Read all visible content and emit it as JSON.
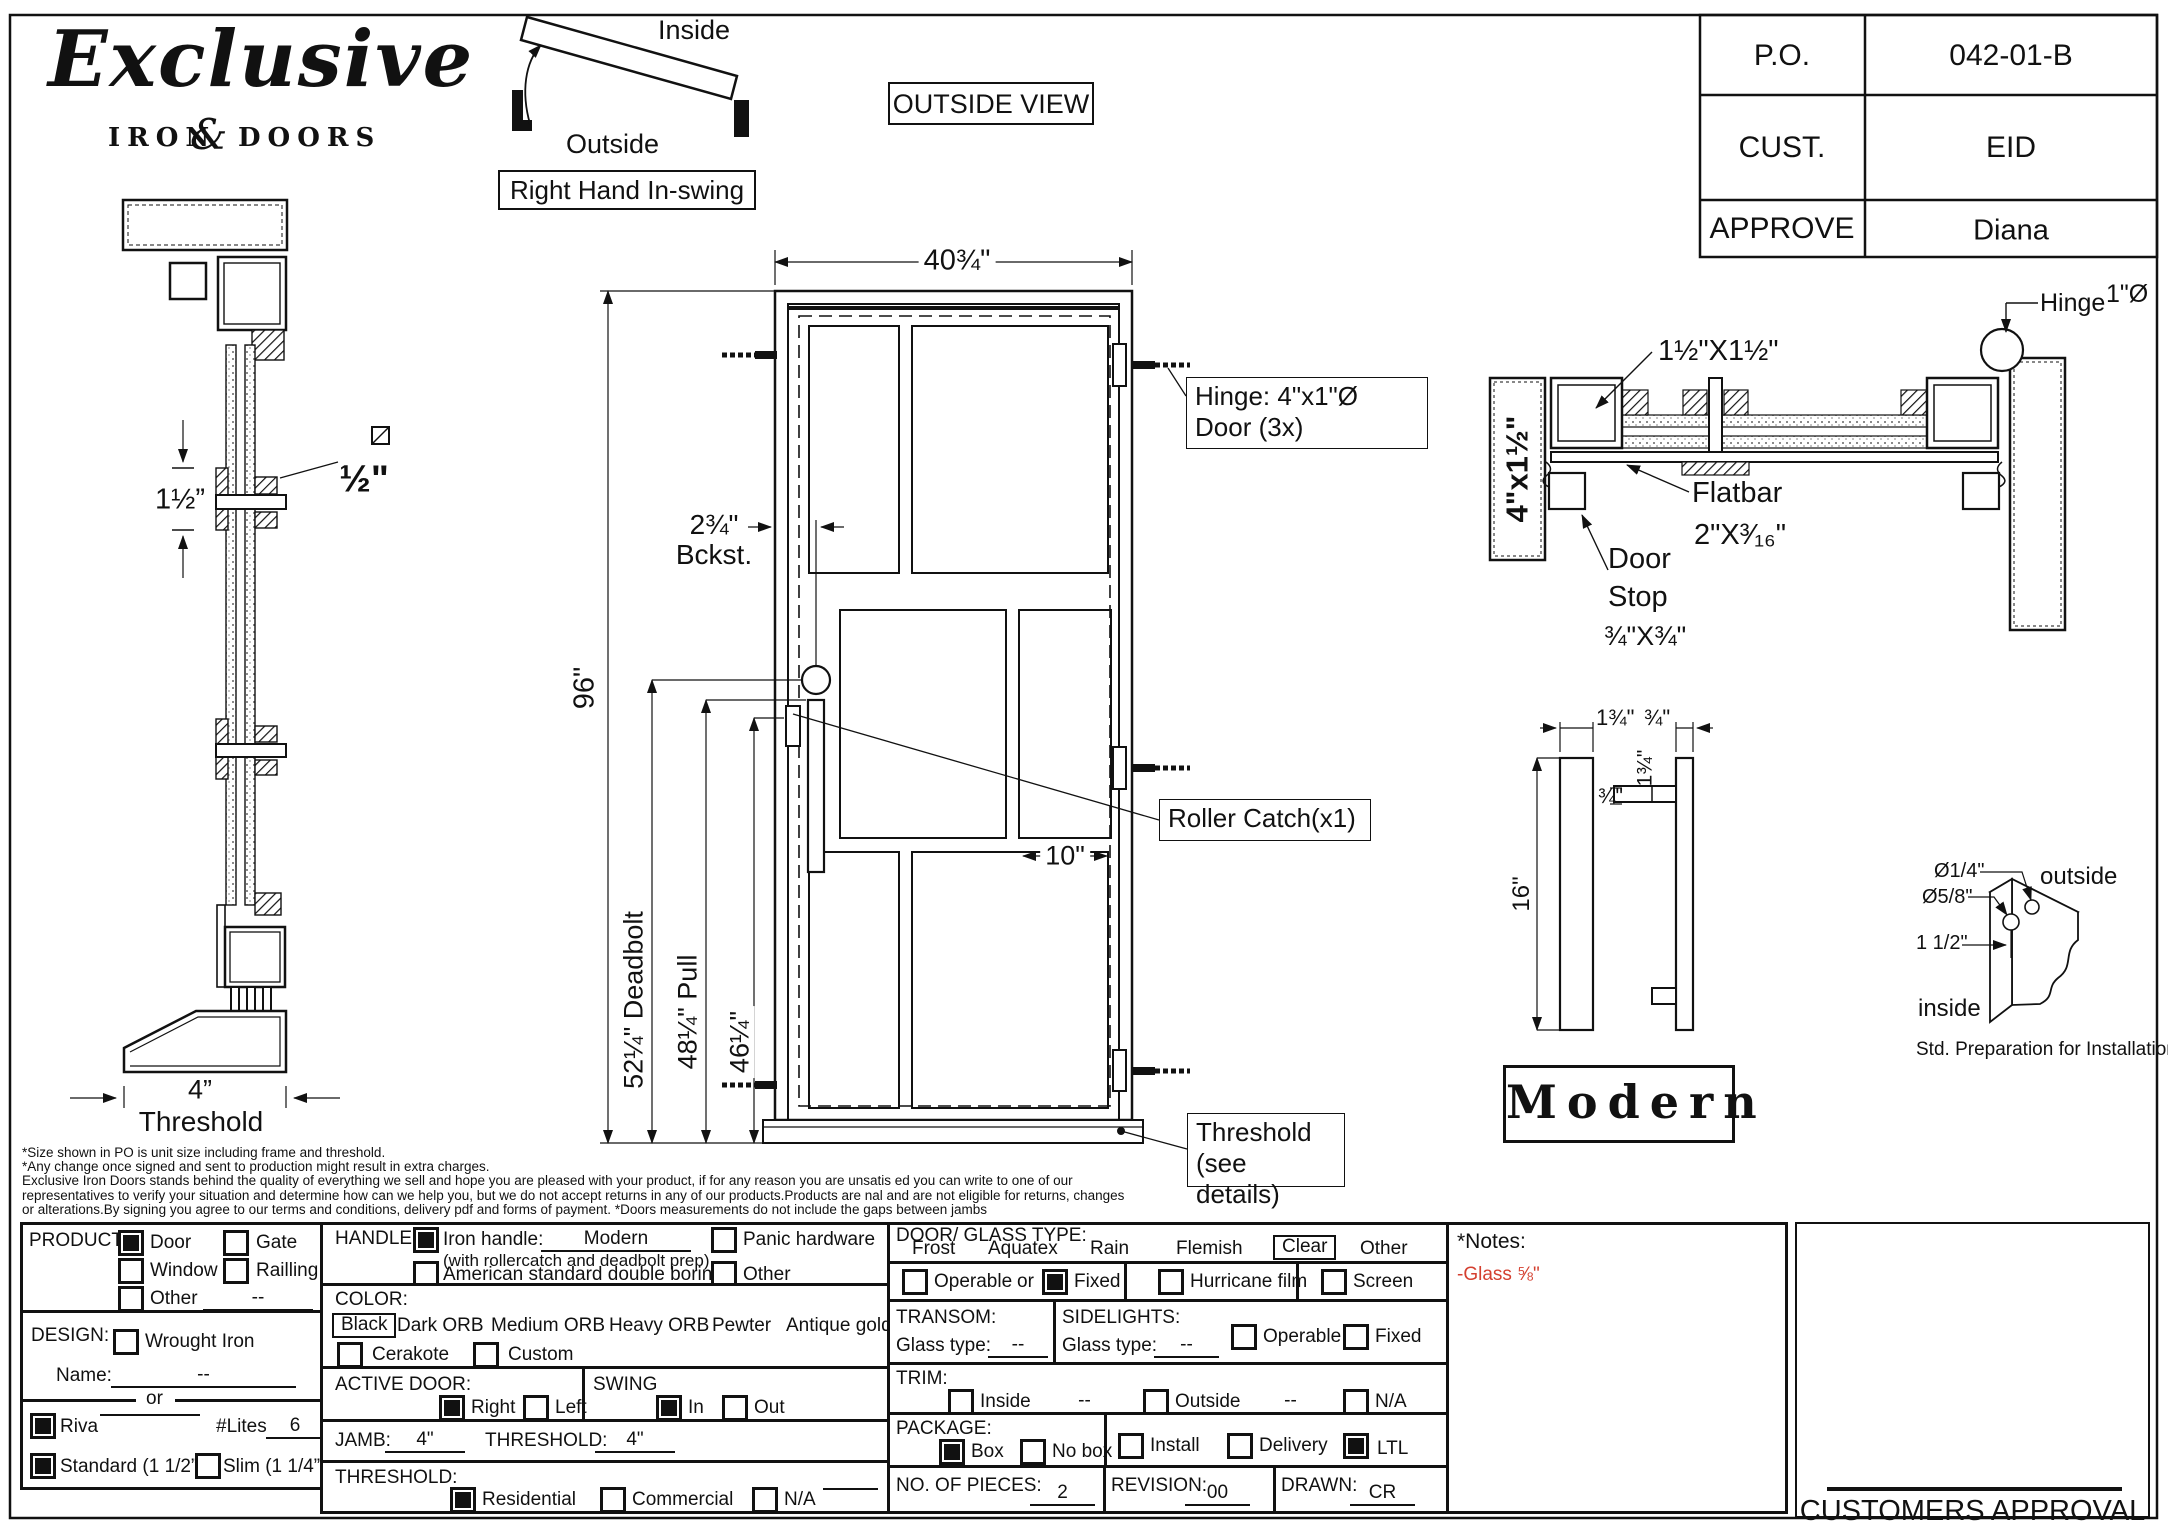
{
  "logo": {
    "script": "Exclusive",
    "sub_left": "IRON",
    "sub_amp": "&",
    "sub_right": "DOORS"
  },
  "swing": {
    "inside": "Inside",
    "outside": "Outside",
    "caption": "Right Hand In-swing"
  },
  "view_box": {
    "label": "OUTSIDE VIEW"
  },
  "po_table": {
    "rows": [
      {
        "label": "P.O.",
        "value": "042-01-B"
      },
      {
        "label": "CUST.",
        "value": "EID"
      },
      {
        "label": "APPROVE",
        "value": "Diana"
      }
    ]
  },
  "door_view": {
    "width_dim": "40¾\"",
    "height_dim": "96\"",
    "deadbolt_dim": "52¼\" Deadbolt",
    "pull_dim": "48¼\" Pull",
    "catch_dim": "46¼\"",
    "backset_line1": "2¾\"",
    "backset_line2": "Bckst.",
    "lite_dim": "10\"",
    "hinge_note_line1": "Hinge: 4\"x1\"Ø",
    "hinge_note_line2": "Door (3x)",
    "roller_note": "Roller Catch(x1)",
    "threshold_note_line1": "Threshold",
    "threshold_note_line2": "(see details)"
  },
  "profile_view": {
    "mullion_dim": "1½”",
    "bar_dim": "½\"",
    "threshold_dim": "4”",
    "threshold_label": "Threshold"
  },
  "section_view": {
    "jamb_dim": "4\"x1½\"",
    "tube_dim": "1½\"X1½\"",
    "hinge_label": "Hinge",
    "hinge_dia": "1\"Ø",
    "flatbar_label": "Flatbar",
    "flatbar_dim": "2\"X³⁄₁₆\"",
    "doorstop_line1": "Door",
    "doorstop_line2": "Stop",
    "doorstop_dim": "¾\"X¾\""
  },
  "handle_detail": {
    "height_dim": "16\"",
    "bar_width_dim": "1¾\"",
    "bar_depth_dim": "¾\"",
    "standoff_dim1": "1¾\"",
    "standoff_dim2": "¾\"",
    "style_name": "Modern"
  },
  "prep_detail": {
    "hole_front": "Ø1/4\"",
    "hole_back": "Ø5/8\"",
    "offset": "1 1/2\"",
    "outside": "outside",
    "inside": "inside",
    "caption": "Std. Preparation for Installation"
  },
  "disclaimer": {
    "lines": [
      "*Size shown in PO is unit size including frame and threshold.",
      "*Any change once signed and sent to production might result in extra charges.",
      "Exclusive Iron Doors stands behind the quality of everything we sell and hope you are pleased with your product, if for any reason you are unsatis   ed you can write to one of our",
      "representatives to verify your situation and determine how can we help you, but we do not accept returns in any of our products.Products are    nal and are not eligible for returns, changes",
      "or alterations.By signing you agree to our terms and conditions, delivery pdf and forms of payment. *Doors measurements do not include the gaps between jambs"
    ]
  },
  "form": {
    "product": {
      "title": "PRODUCT:",
      "options": [
        {
          "label": "Door",
          "checked": true
        },
        {
          "label": "Gate",
          "checked": false
        },
        {
          "label": "Window",
          "checked": false
        },
        {
          "label": "Railling",
          "checked": false
        },
        {
          "label": "Other",
          "checked": false
        }
      ],
      "other_value": "--"
    },
    "design": {
      "title": "DESIGN:",
      "wrought_iron": {
        "label": "Wrought Iron",
        "checked": false
      },
      "name_label": "Name:",
      "name_value": "--",
      "or_label": "or",
      "riva": {
        "label": "Riva",
        "checked": true
      },
      "lites_label": "#Lites",
      "lites_value": "6",
      "standard": {
        "label": "Standard (1 1/2”)",
        "checked": true
      },
      "slim": {
        "label": "Slim (1 1/4”)",
        "checked": false
      }
    },
    "handle": {
      "title": "HANDLE:",
      "iron_handle_label": "Iron handle:",
      "iron_handle_value": "Modern",
      "iron_handle_checked": true,
      "iron_handle_sub": "(with rollercatch and deadbolt prep)",
      "american_label": "American standard double boring",
      "panic_label": "Panic hardware",
      "other_label": "Other"
    },
    "color": {
      "title": "COLOR:",
      "selected": "Black",
      "options": [
        "Black",
        "Dark ORB",
        "Medium ORB",
        "Heavy ORB",
        "Pewter",
        "Antique gold"
      ],
      "cerakote_label": "Cerakote",
      "custom_label": "Custom"
    },
    "active_door": {
      "title": "ACTIVE DOOR:",
      "right_label": "Right",
      "left_label": "Left",
      "right_checked": true
    },
    "swing": {
      "title": "SWING",
      "in_label": "In",
      "out_label": "Out",
      "in_checked": true
    },
    "jamb": {
      "label": "JAMB:",
      "value": "4\"",
      "threshold_label": "THRESHOLD:",
      "threshold_value": "4\""
    },
    "threshold": {
      "title": "THRESHOLD:",
      "residential": "Residential",
      "commercial": "Commercial",
      "na": "N/A",
      "residential_checked": true
    },
    "glass": {
      "title": "DOOR/ GLASS TYPE:",
      "types": [
        "Frost",
        "Aquatex",
        "Rain",
        "Flemish",
        "Clear",
        "Other"
      ],
      "selected": "Clear",
      "operable_label": "Operable",
      "or_label": "or",
      "fixed_label": "Fixed",
      "fixed_checked": true,
      "hurricane_label": "Hurricane film",
      "screen_label": "Screen"
    },
    "transom": {
      "title": "TRANSOM:",
      "glass_type_label": "Glass type:",
      "glass_type_value": "--"
    },
    "sidelights": {
      "title": "SIDELIGHTS:",
      "glass_type_label": "Glass type:",
      "glass_type_value": "--",
      "operable_label": "Operable",
      "fixed_label": "Fixed"
    },
    "trim": {
      "title": "TRIM:",
      "inside_label": "Inside",
      "inside_value": "--",
      "outside_label": "Outside",
      "outside_value": "--",
      "na_label": "N/A"
    },
    "package": {
      "title": "PACKAGE:",
      "box_label": "Box",
      "box_checked": true,
      "nobox_label": "No box",
      "install_label": "Install",
      "delivery_label": "Delivery",
      "ltl_label": "LTL",
      "ltl_checked": true
    },
    "pieces": {
      "label": "NO. OF  PIECES:",
      "value": "2"
    },
    "revision": {
      "label": "REVISION:",
      "value": "00"
    },
    "drawn": {
      "label": "DRAWN:",
      "value": "CR"
    }
  },
  "notes": {
    "title": "*Notes:",
    "glass_note": "-Glass ⅝\"",
    "note_color": "#d43f2f"
  },
  "approval": {
    "label": "CUSTOMERS APPROVAL"
  }
}
